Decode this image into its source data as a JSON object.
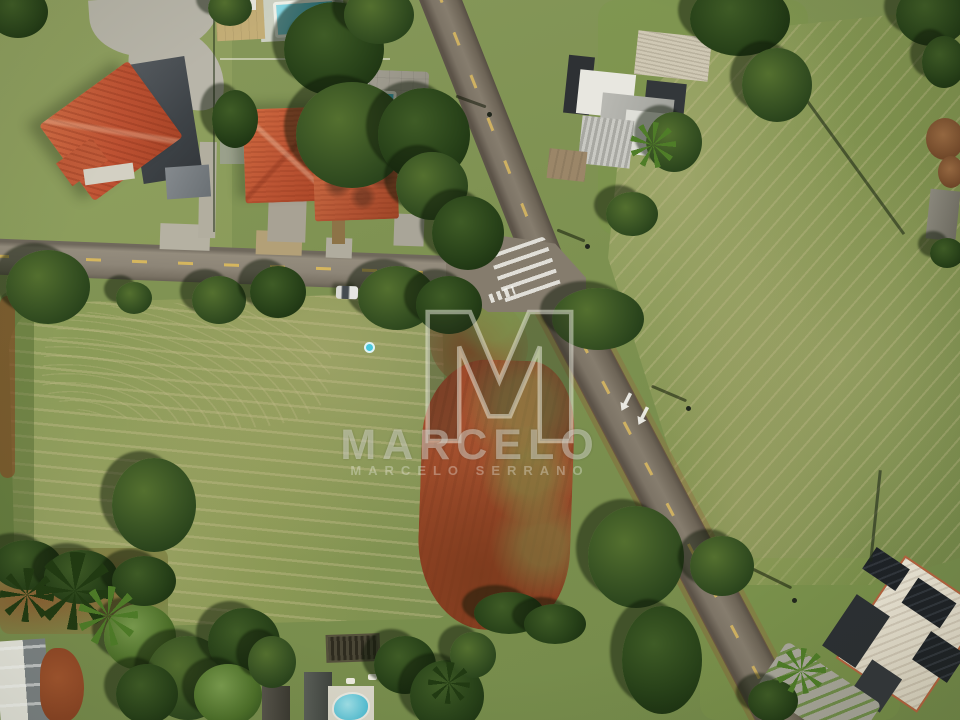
{
  "watermark": {
    "logo_letter": "M",
    "brand": "MARCELO",
    "subtitle": "MARCELO SERRANO"
  },
  "palette": {
    "grass": "#7d9150",
    "grass_dry": "#c9bd8f",
    "tree_green": "#2c431d",
    "asphalt_light": "#8d8577",
    "asphalt_dark": "#6e6557",
    "dirt_red": "#9a4628",
    "roof_terracotta": "#bd5534",
    "roof_modern_gray": "#b9b9b3",
    "pool_aqua": "#3fb2cb",
    "lane_yellow": "#e1be5a",
    "concrete": "#b5b1a2",
    "watermark_white": "#f4f4ec"
  }
}
